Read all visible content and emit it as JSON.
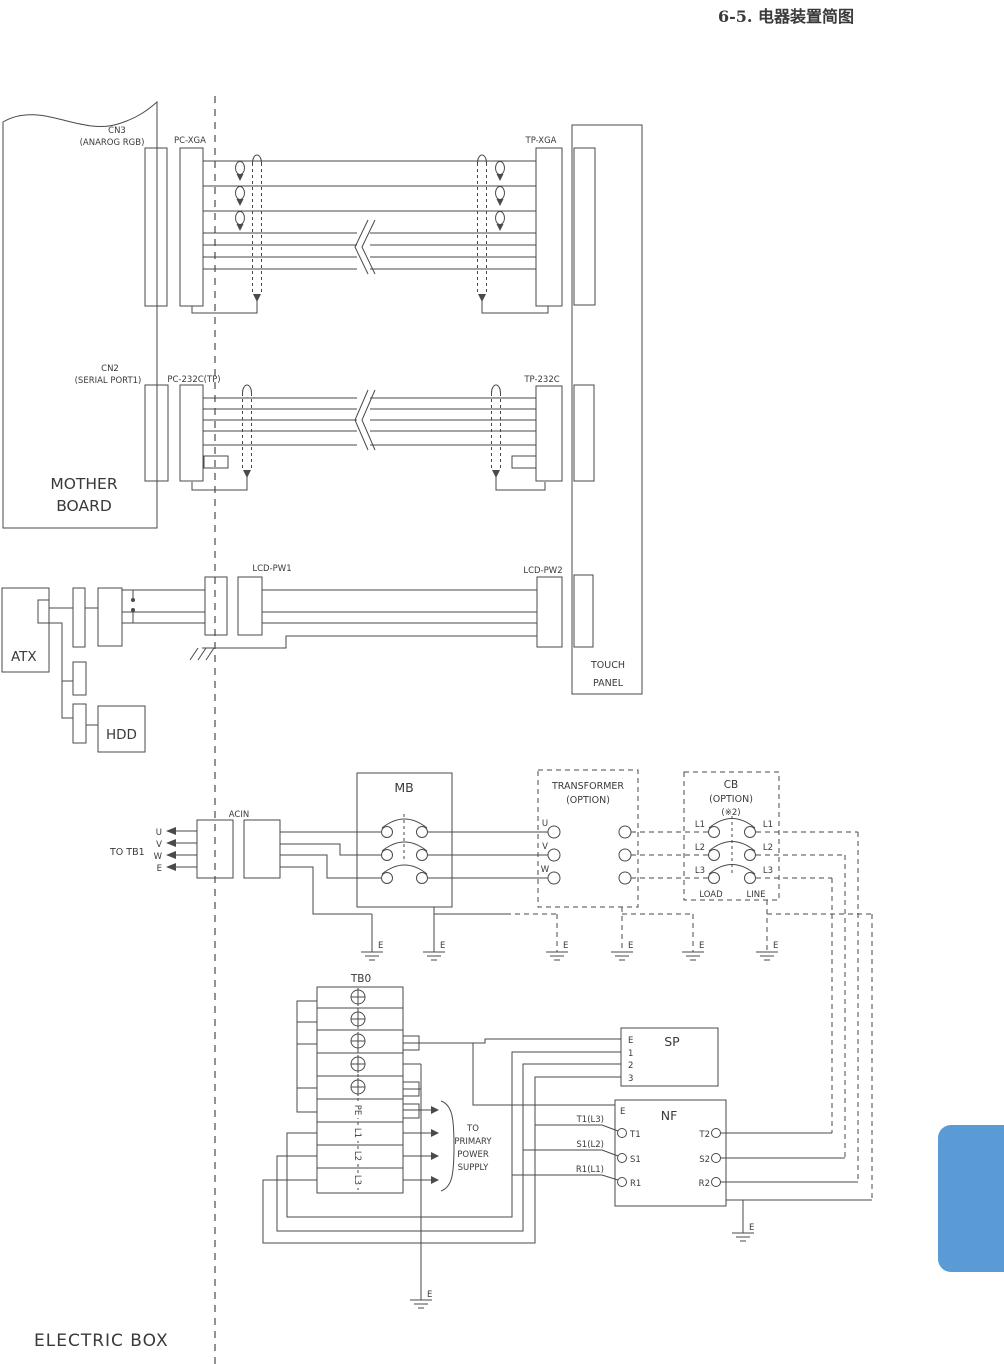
{
  "title": "6-5. 电器装置简图",
  "motherboard": {
    "line1": "MOTHER",
    "line2": "BOARD",
    "cn3": "CN3",
    "cn3_sub": "(ANAROG RGB)",
    "cn2": "CN2",
    "cn2_sub": "(SERIAL PORT1)"
  },
  "connectors": {
    "pc_xga": "PC-XGA",
    "tp_xga": "TP-XGA",
    "pc_232c": "PC-232C(TP)",
    "tp_232c": "TP-232C",
    "lcd_pw1": "LCD-PW1",
    "lcd_pw2": "LCD-PW2"
  },
  "touch_panel": {
    "line1": "TOUCH",
    "line2": "PANEL"
  },
  "devices": {
    "atx": "ATX",
    "hdd": "HDD"
  },
  "power": {
    "acin": "ACIN",
    "to_tb1": "TO TB1",
    "u": "U",
    "v": "V",
    "w": "W",
    "e": "E",
    "mb": "MB"
  },
  "transformer": {
    "line1": "TRANSFORMER",
    "line2": "(OPTION)"
  },
  "cb": {
    "line1": "CB",
    "line2": "(OPTION)",
    "line3": "(※2)",
    "l1": "L1",
    "l2": "L2",
    "l3": "L3",
    "load": "LOAD",
    "line": "LINE"
  },
  "tb0": {
    "label": "TB0",
    "pe": "PE",
    "l1": "L1",
    "l2": "L2",
    "l3": "L3"
  },
  "primary": {
    "line1": "TO",
    "line2": "PRIMARY",
    "line3": "POWER",
    "line4": "SUPPLY"
  },
  "sp": {
    "label": "SP",
    "e": "E",
    "n1": "1",
    "n2": "2",
    "n3": "3"
  },
  "nf": {
    "label": "NF",
    "e": "E",
    "t1": "T1",
    "s1": "S1",
    "r1": "R1",
    "t2": "T2",
    "s2": "S2",
    "r2": "R2",
    "t1_src": "T1(L3)",
    "s1_src": "S1(L2)",
    "r1_src": "R1(L1)"
  },
  "ground": {
    "e": "E"
  },
  "footer": {
    "electric_box": "ELECTRIC BOX"
  },
  "colors": {
    "line": "#4a4a4a",
    "text": "#3a3a3a",
    "accent_blue": "#5b9bd5"
  }
}
